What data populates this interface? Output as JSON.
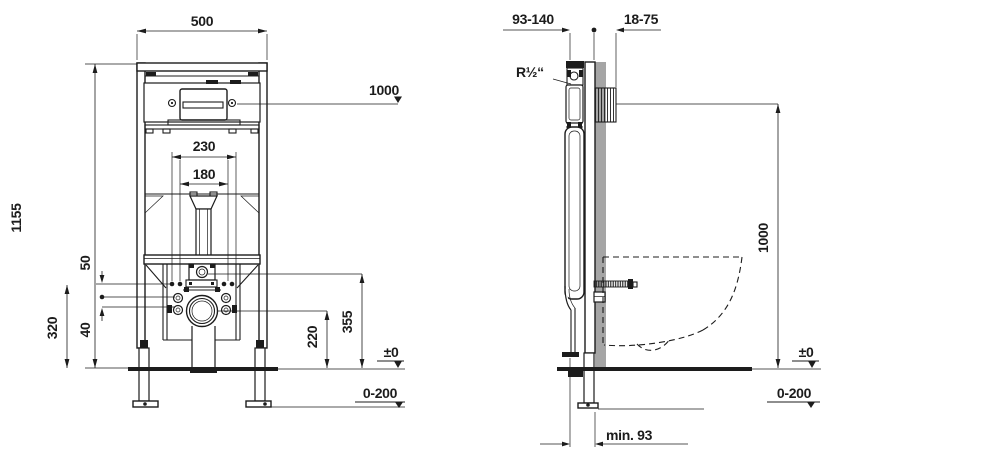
{
  "drawing": {
    "front": {
      "frame_width": "500",
      "frame_height": "1155",
      "actuator_height": "1000",
      "fixing_spread_outer": "230",
      "fixing_spread_inner": "180",
      "offset_upper": "50",
      "offset_lower": "40",
      "fixing_height": "320",
      "inlet_height": "355",
      "outlet_height": "220",
      "floor_level": "±0",
      "floor_adjust_range": "0-200"
    },
    "side": {
      "frame_depth_range": "93-140",
      "finish_depth_range": "18-75",
      "water_connection": "R½“",
      "actuator_height": "1000",
      "floor_level": "±0",
      "floor_adjust_range": "0-200",
      "min_wall_distance": "min. 93"
    },
    "colors": {
      "line": "#1c1c1c",
      "wall_fill": "#a5a5a5",
      "background": "#ffffff"
    }
  }
}
